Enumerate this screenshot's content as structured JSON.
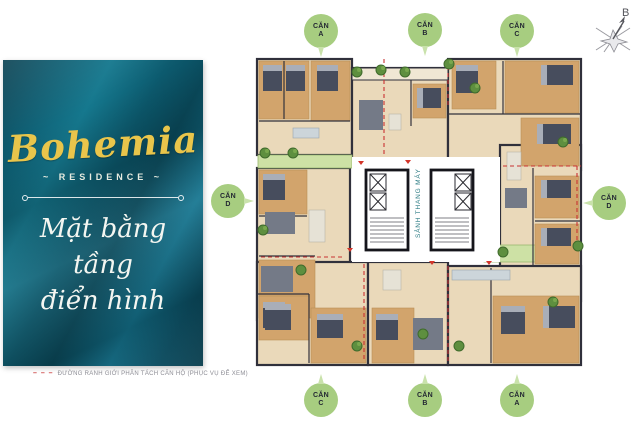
{
  "brand": {
    "name": "Bohemia",
    "residence": "~ RESIDENCE ~",
    "title_line1": "Mặt bằng",
    "title_line2": "tầng",
    "title_line3": "điển hình"
  },
  "legend": {
    "dashes": "– – –",
    "text": "ĐƯỜNG RANH GIỚI PHÂN TÁCH CĂN HỘ (PHỤC VỤ ĐỂ XEM)"
  },
  "compass": {
    "label": "B"
  },
  "floorplan": {
    "core_label": "SẢNH THANG MÁY"
  },
  "unit_markers": {
    "top": [
      {
        "line1": "CĂN",
        "line2": "A"
      },
      {
        "line1": "CĂN",
        "line2": "B"
      },
      {
        "line1": "CĂN",
        "line2": "C"
      }
    ],
    "bottom": [
      {
        "line1": "CĂN",
        "line2": "C"
      },
      {
        "line1": "CĂN",
        "line2": "B"
      },
      {
        "line1": "CĂN",
        "line2": "A"
      }
    ],
    "left": {
      "line1": "CĂN",
      "line2": "D"
    },
    "right": {
      "line1": "CĂN",
      "line2": "D"
    }
  },
  "colors": {
    "panel_teal": "#0c5d72",
    "accent_yellow": "#e9c54b",
    "marker_green": "#a7cd80",
    "divider_red": "#c83232",
    "wall": "#30303b",
    "floor_tan": "#ead9ba",
    "floor_wood": "#d2a46c",
    "garden_green": "#cde1a5",
    "core_text_teal": "#2e7d85"
  }
}
